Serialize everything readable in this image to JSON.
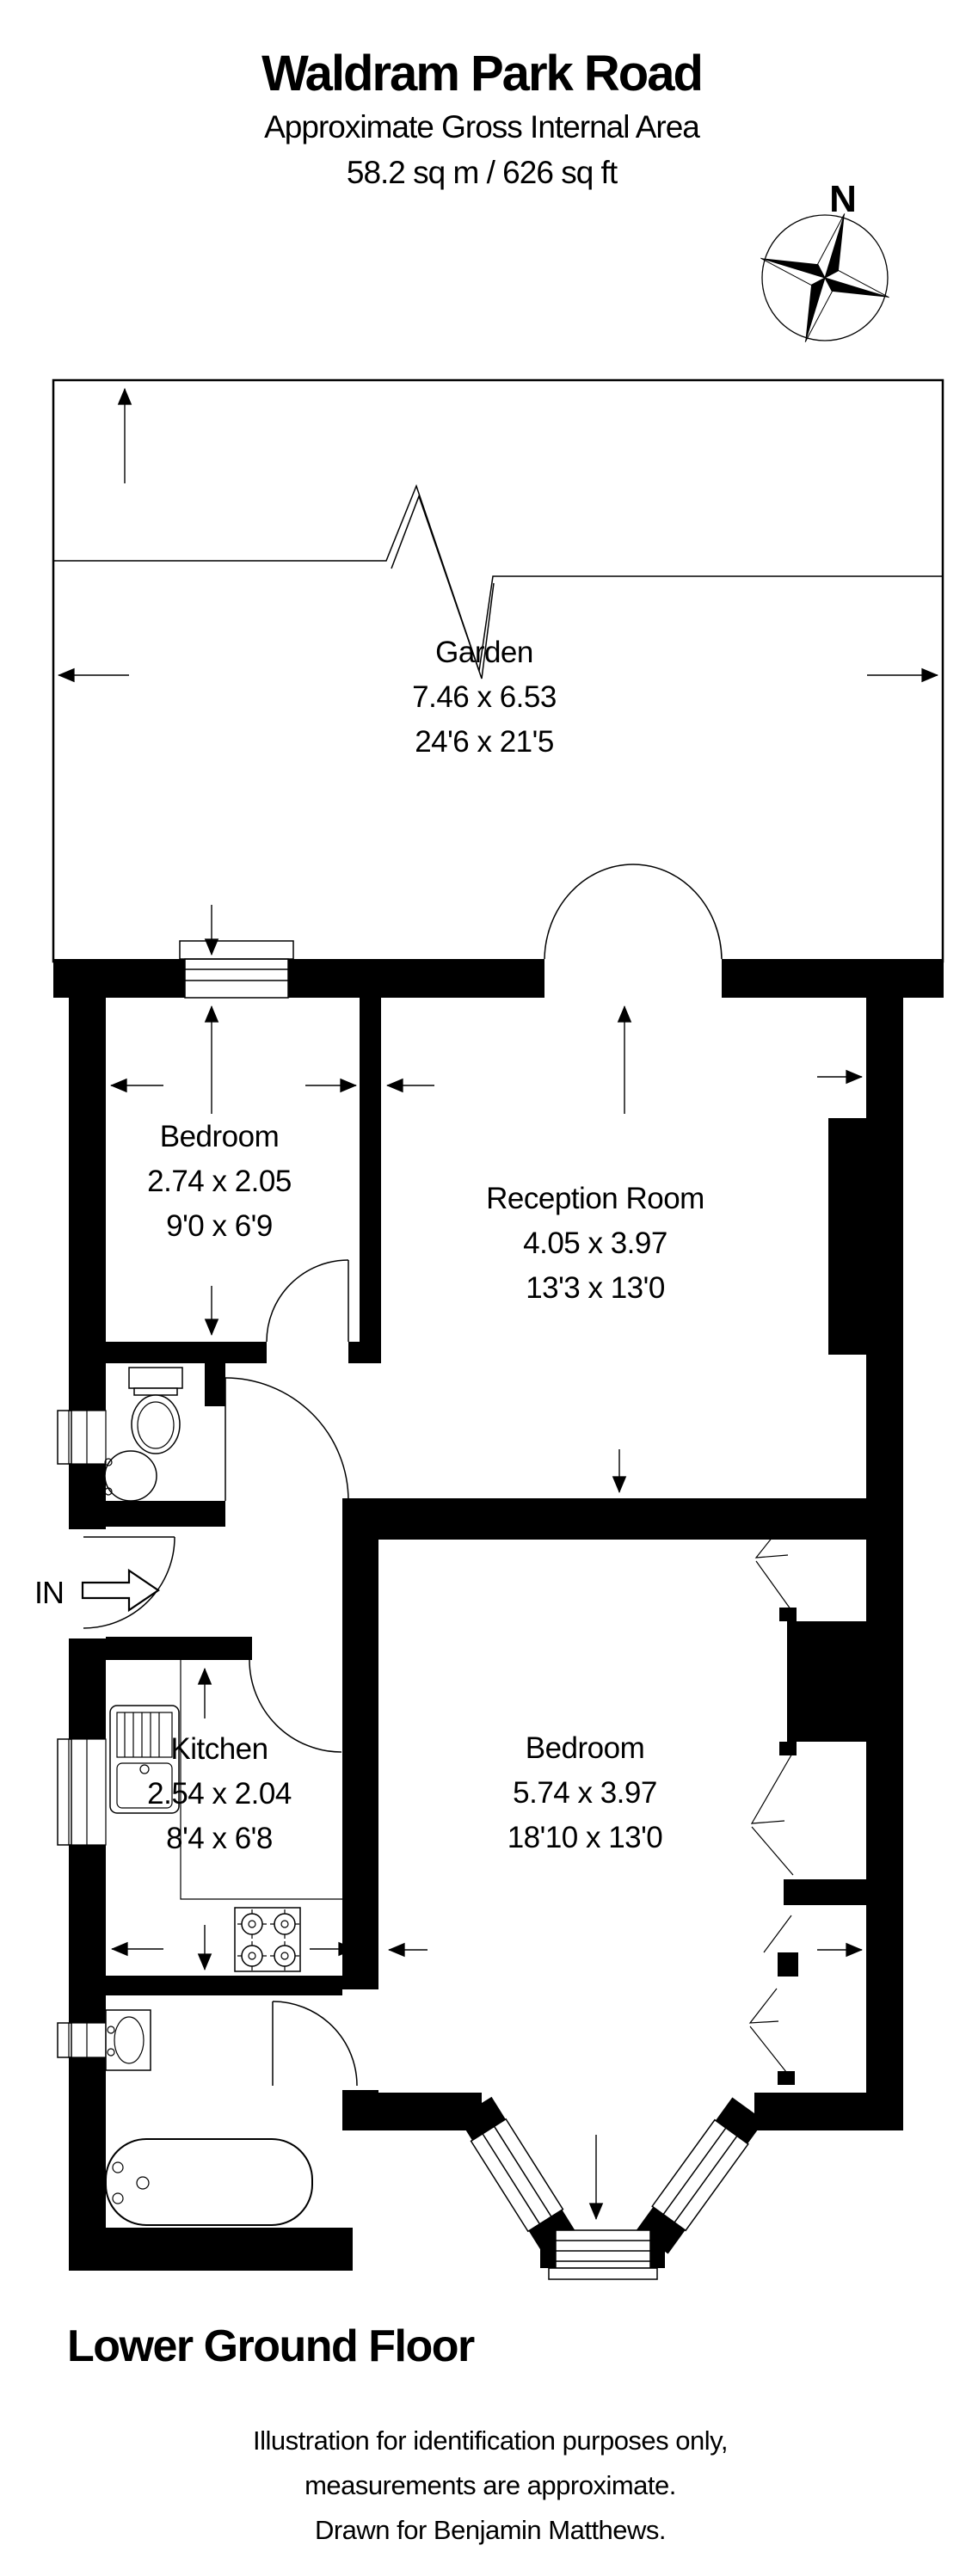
{
  "header": {
    "title": "Waldram Park Road",
    "subtitle": "Approximate Gross Internal Area",
    "area": "58.2 sq m / 626 sq ft"
  },
  "compass": {
    "north_label": "N"
  },
  "rooms": {
    "garden": {
      "name": "Garden",
      "size_metric": "7.46 x 6.53",
      "size_imperial": "24'6 x 21'5"
    },
    "bedroom_top": {
      "name": "Bedroom",
      "size_metric": "2.74 x 2.05",
      "size_imperial": "9'0 x 6'9"
    },
    "reception": {
      "name": "Reception Room",
      "size_metric": "4.05 x 3.97",
      "size_imperial": "13'3 x 13'0"
    },
    "kitchen": {
      "name": "Kitchen",
      "size_metric": "2.54 x 2.04",
      "size_imperial": "8'4 x 6'8"
    },
    "bedroom_main": {
      "name": "Bedroom",
      "size_metric": "5.74 x 3.97",
      "size_imperial": "18'10 x 13'0"
    }
  },
  "entrance": {
    "label": "IN"
  },
  "floor": {
    "label": "Lower Ground Floor"
  },
  "disclaimer": {
    "line1": "Illustration for identification purposes only,",
    "line2": "measurements are approximate.",
    "line3": "Drawn for Benjamin Matthews."
  },
  "colors": {
    "wall": "#000000",
    "background": "#ffffff",
    "line": "#000000"
  }
}
